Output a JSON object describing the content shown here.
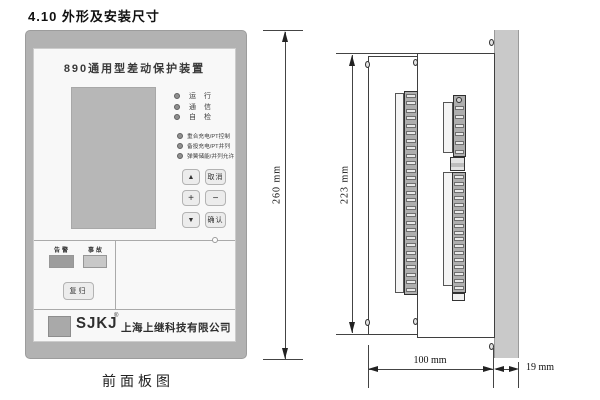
{
  "page": {
    "section_title": "4.10 外形及安装尺寸",
    "front_caption": "前面板图"
  },
  "front_panel": {
    "device_title": "890通用型差动保护装置",
    "status_leds": [
      "运  行",
      "通  信",
      "自  检"
    ],
    "function_leds": [
      "重合充电/PT控制",
      "备投充电/PT并列",
      "弹簧储能/并列允许"
    ],
    "keypad": [
      "▲",
      "取消",
      "+",
      "−",
      "▼",
      "确认"
    ],
    "signal_lamps": {
      "alarm": "告警",
      "fault": "事故"
    },
    "reset_button": "复归",
    "brand": {
      "logo": "SJKJ",
      "reg": "®",
      "company": "上海上继科技有限公司"
    }
  },
  "side_view": {
    "dims": {
      "total_height": "260 mm",
      "body_height": "223 mm",
      "depth": "100 mm",
      "panel_thickness": "19 mm"
    },
    "left_terminal_count": 27,
    "right_upper_terminal_count": 6,
    "right_lower_terminal_count": 17
  },
  "colors": {
    "panel_frame": "#b2b2b2",
    "panel_face": "#f8f8f8",
    "lcd": "#b7b7b7",
    "alarm_lamp": "#9d9d9d",
    "fault_lamp": "#c8c8c8",
    "logo_square": "#a9a9a9",
    "wall": "#c9c9c9"
  }
}
